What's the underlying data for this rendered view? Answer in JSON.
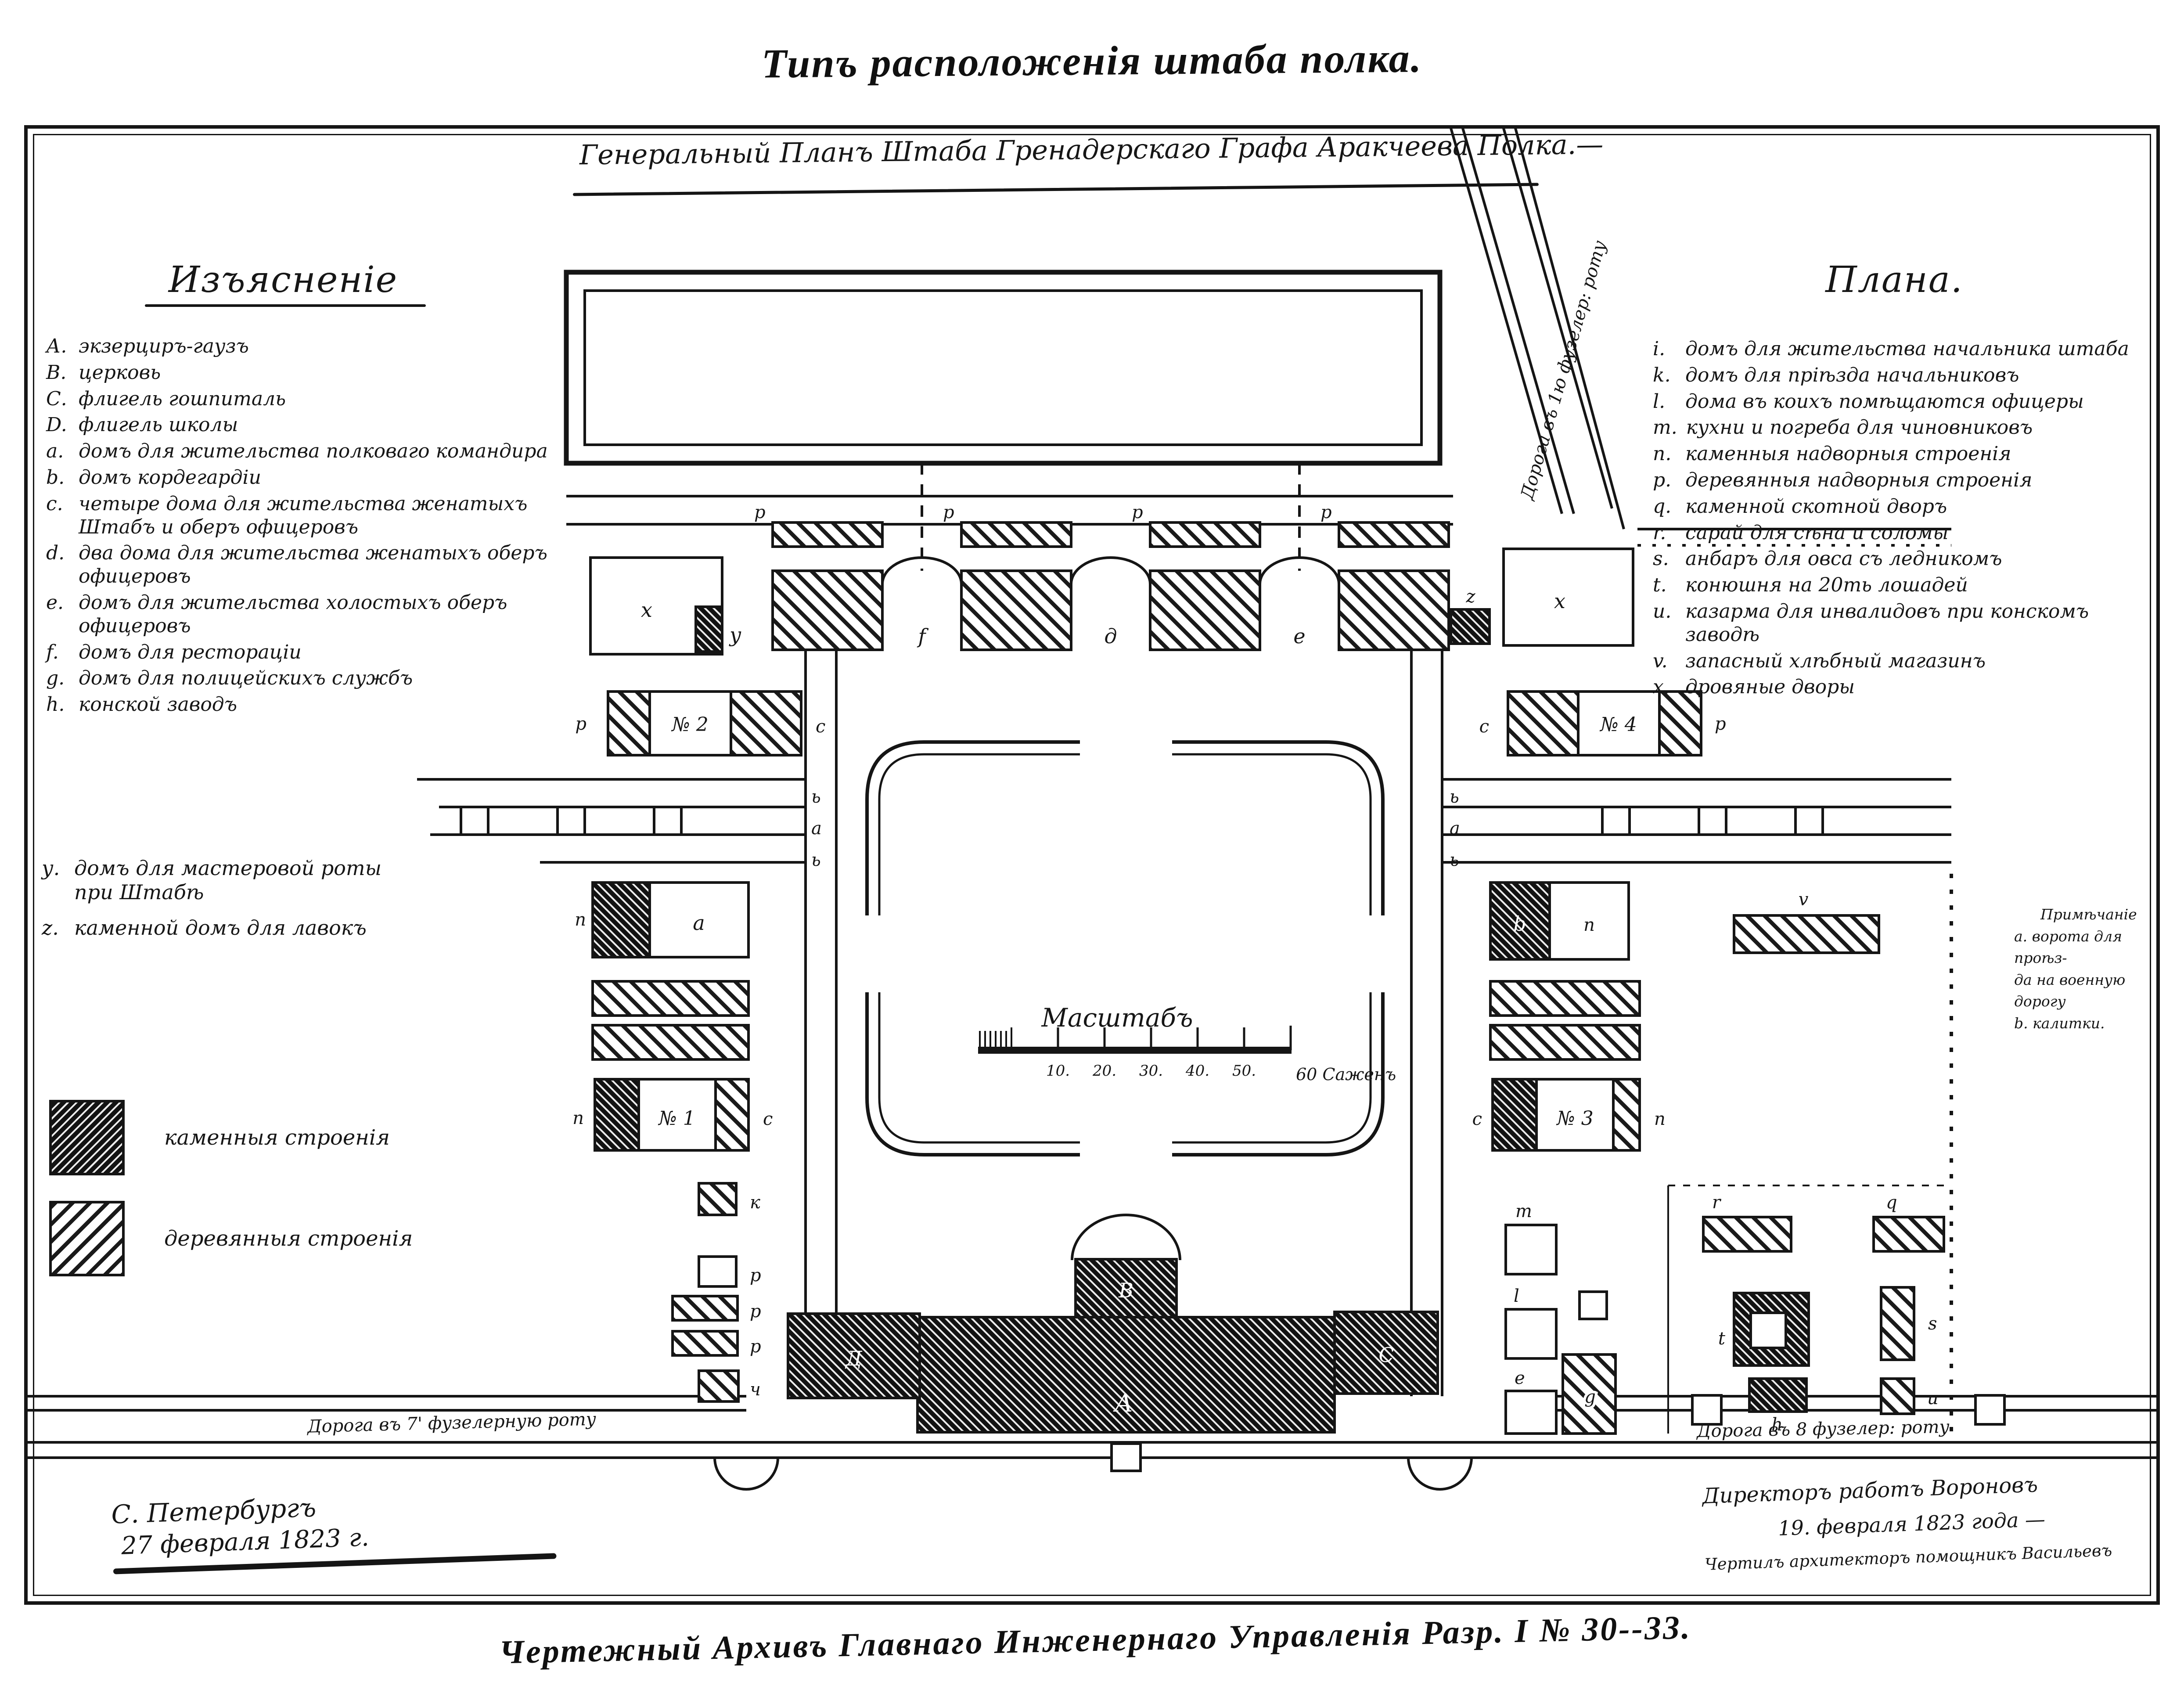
{
  "page": {
    "top_title": "Типъ расположенія штаба полка.",
    "bottom_caption": "Чертежный Архивъ Главнаго Инженернаго Управленія Разр. I № 30--33."
  },
  "plan_title": "Генеральный Планъ Штаба Гренадерскаго Графа Аракчеева Полка.—",
  "legend_left": {
    "title": "Изъясненіе",
    "items": [
      {
        "k": "А.",
        "t": "экзерциръ-гаузъ"
      },
      {
        "k": "В.",
        "t": "церковь"
      },
      {
        "k": "С.",
        "t": "флигель гошпиталь"
      },
      {
        "k": "D.",
        "t": "флигель школы"
      },
      {
        "k": "а.",
        "t": "домъ для жительства полковаго командира"
      },
      {
        "k": "b.",
        "t": "домъ кордегардіи"
      },
      {
        "k": "с.",
        "t": "четыре дома для жительства женатыхъ Штабъ и оберъ офицеровъ"
      },
      {
        "k": "d.",
        "t": "два дома для жительства женатыхъ оберъ офицеровъ"
      },
      {
        "k": "е.",
        "t": "домъ для жительства холостыхъ оберъ офицеровъ"
      },
      {
        "k": "f.",
        "t": "домъ для рестораціи"
      },
      {
        "k": "g.",
        "t": "домъ для полицейскихъ службъ"
      },
      {
        "k": "h.",
        "t": "конской заводъ"
      }
    ],
    "items2": [
      {
        "k": "у.",
        "t": "домъ для мастеровой роты при Штабѣ"
      },
      {
        "k": "z.",
        "t": "каменной домъ для лавокъ"
      }
    ],
    "swatches": [
      {
        "label": "каменныя строенія"
      },
      {
        "label": "деревянныя строенія"
      }
    ]
  },
  "legend_right": {
    "title": "Плана.",
    "items": [
      {
        "k": "i.",
        "t": "домъ для жительства начальника штаба"
      },
      {
        "k": "k.",
        "t": "домъ для пріѣзда начальниковъ"
      },
      {
        "k": "l.",
        "t": "дома въ коихъ помѣщаются офицеры"
      },
      {
        "k": "m.",
        "t": "кухни и погреба для чиновниковъ"
      },
      {
        "k": "n.",
        "t": "каменныя надворныя строенія"
      },
      {
        "k": "p.",
        "t": "деревянныя надворныя строенія"
      },
      {
        "k": "q.",
        "t": "каменной скотной дворъ"
      },
      {
        "k": "r.",
        "t": "сарай для сѣна и соломы"
      },
      {
        "k": "s.",
        "t": "анбаръ для овса съ ледникомъ"
      },
      {
        "k": "t.",
        "t": "конюшня на 20ть лошадей"
      },
      {
        "k": "u.",
        "t": "казарма для инвалидовъ при конскомъ заводѣ"
      },
      {
        "k": "v.",
        "t": "запасный хлѣбный магазинъ"
      },
      {
        "k": "x.",
        "t": "дровяные дворы"
      }
    ]
  },
  "note_right": {
    "title": "Примѣчаніе",
    "line1": "а. ворота для проѣз-",
    "line2": "да на военную дорогу",
    "line3": "b. калитки."
  },
  "roads": {
    "left": "Дорога въ 7' фузелерную роту",
    "right": "Дорога въ 8 фузелер: роту",
    "diag": "Дорога въ 1ю фузелер: роту"
  },
  "scale": {
    "label": "Масштабъ",
    "t10": "10.",
    "t20": "20.",
    "t30": "30.",
    "t40": "40.",
    "t50": "50.",
    "t60": "60 Саженъ"
  },
  "signoff": {
    "left1": "С. Петербургъ",
    "left2": "27 февраля 1823 г.",
    "right1": "Директоръ работъ Вороновъ",
    "right2": "19. февраля 1823 года —",
    "right3": "Чертилъ архитекторъ помощникъ Васильевъ"
  },
  "labels": {
    "p": "p",
    "x": "x",
    "y": "у",
    "z": "z",
    "f": "f",
    "d": "д",
    "e": "е",
    "n1": "№ 1",
    "n2": "№ 2",
    "n3": "№ 3",
    "n4": "№ 4",
    "c": "с",
    "pp": "п",
    "b_small": "ь",
    "a_small": "а",
    "a": "а",
    "b": "b",
    "v": "v",
    "r": "r",
    "q": "q",
    "t": "t",
    "s": "s",
    "h": "h",
    "u": "u",
    "m": "m",
    "l": "l",
    "e2": "е",
    "g": "g",
    "k": "к",
    "r2": "р",
    "ch": "ч",
    "A": "А",
    "B": "В",
    "C": "С",
    "D": "Д"
  }
}
